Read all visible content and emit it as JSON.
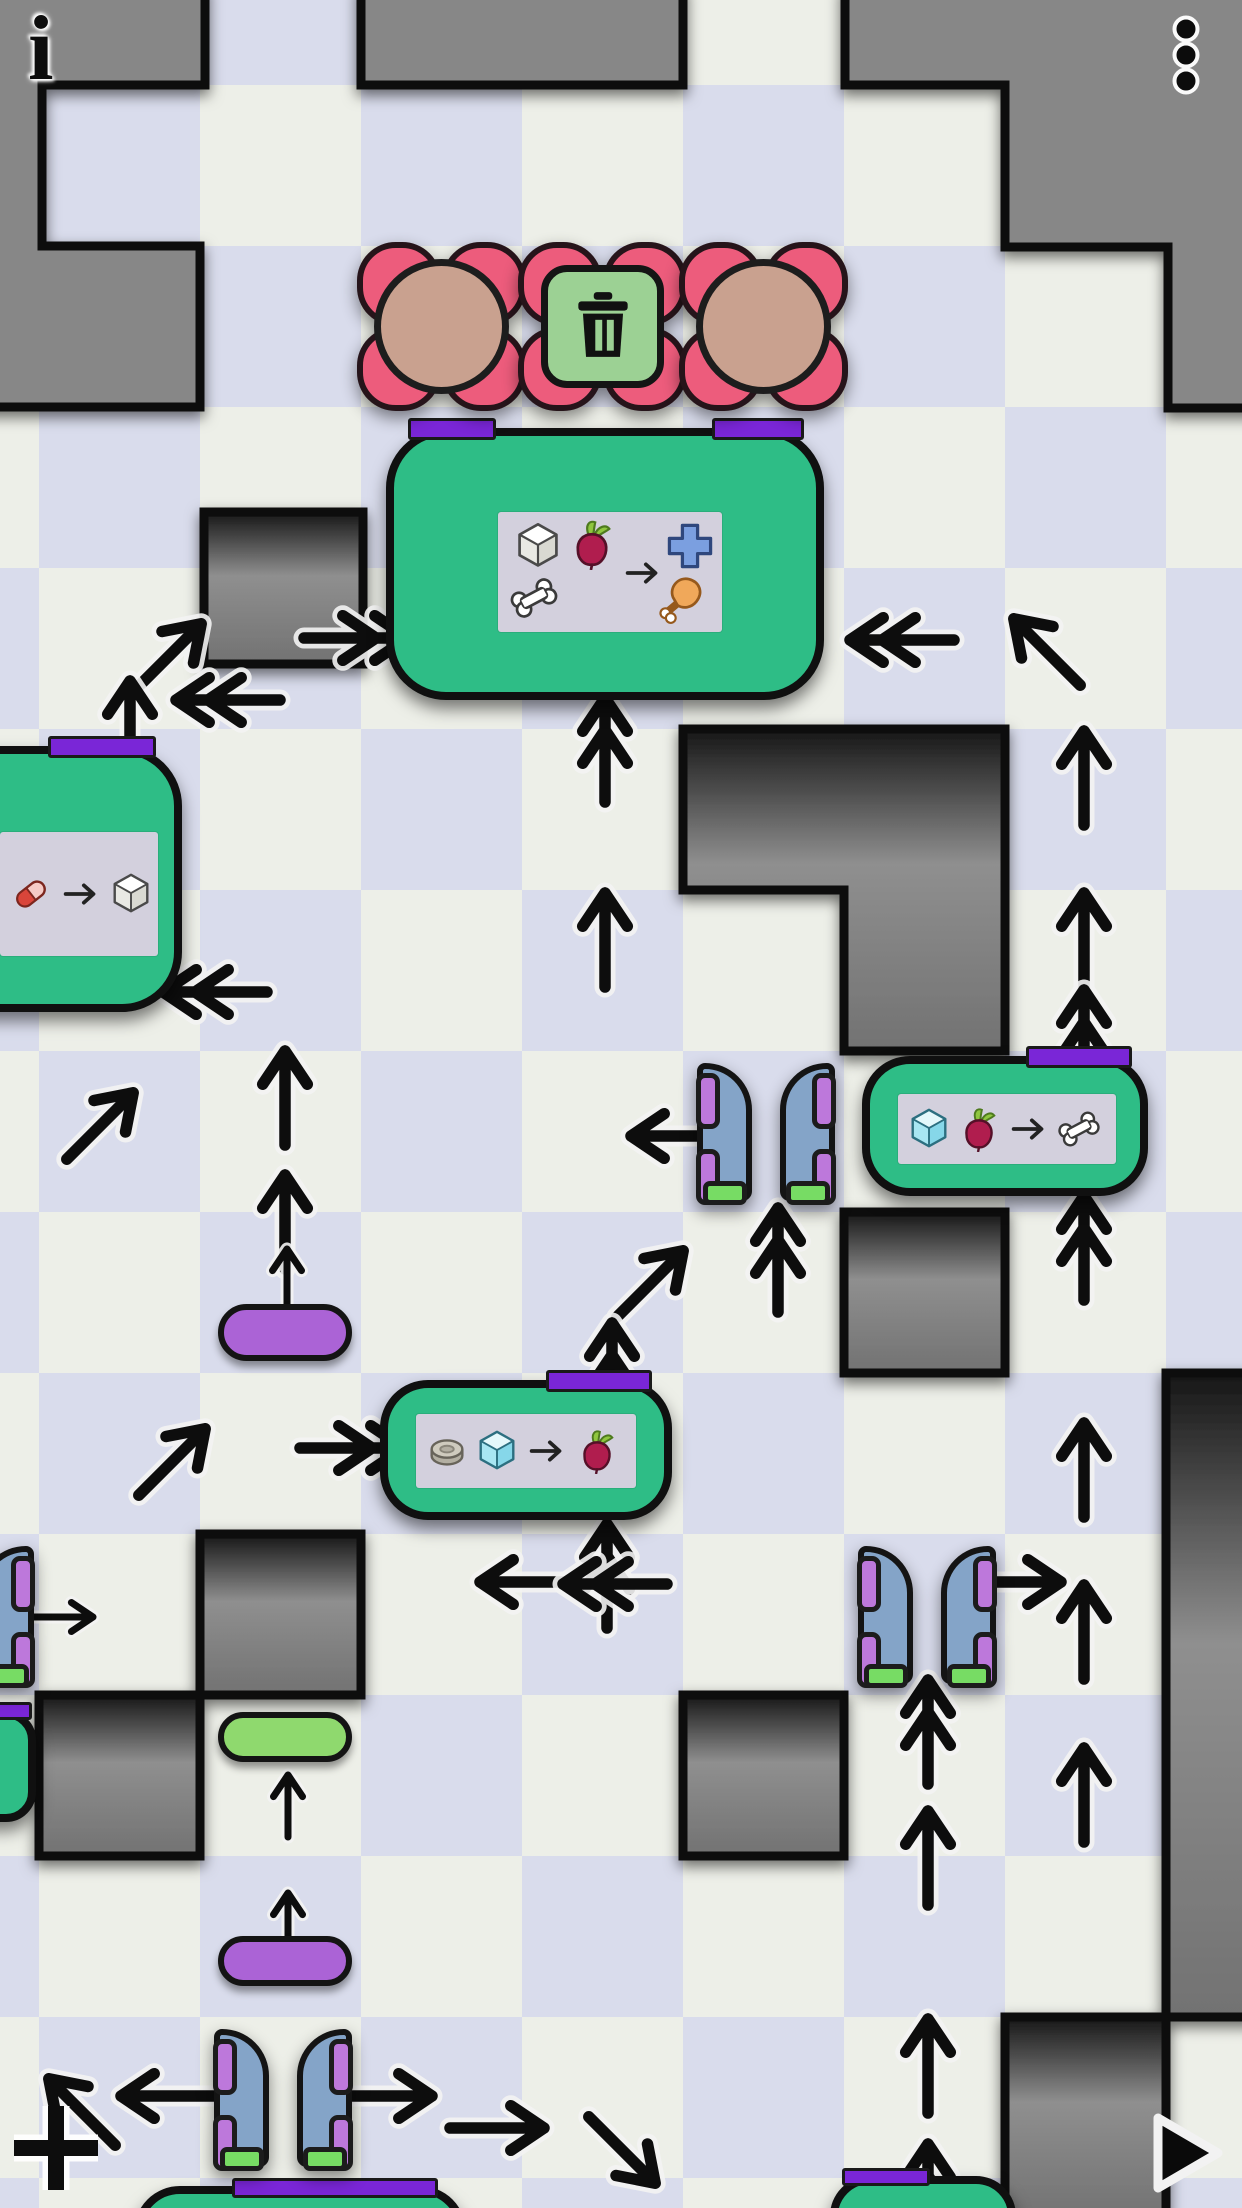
{
  "app": {
    "title": "factory puzzle level"
  },
  "hud": {
    "info_glyph": "i",
    "menu_icon": "vertical-ellipsis-icon",
    "add_icon": "plus-icon",
    "play_icon": "play-triangle-icon"
  },
  "palette": {
    "checker_light": "#edefe8",
    "checker_dark": "#d9dcec",
    "wall_flat": "#878787",
    "wall_border": "#101010",
    "machine_green": "#2ebd86",
    "port_purple": "#7a26d7",
    "panel_gray": "#d3d0dd",
    "petal_pink": "#ed5c7c",
    "bear_tan": "#c9a18f",
    "trash_green": "#9cd194",
    "door_blue": "#84a4c8",
    "tab_purple": "#bd78db",
    "bar_green": "#77dc64",
    "pill_purple": "#ab63d6",
    "pill_green": "#8fd96e"
  },
  "board": {
    "tile_size": 161,
    "origin_x": 39,
    "origin_y": 85,
    "flat_walls": [
      "M-12 -12 H205 V85 H42 V246 H200 V407 H-12 Z",
      "M361 -12 H683 V85 H361 Z",
      "M845 -12 H1254 V408 H1168 V247 H1005 V85 H845 Z"
    ],
    "block_walls": [
      "M204 512 H363 V664 H204 Z",
      "M683 729 H1005 V1051 H844 V890 H683 Z",
      "M844 1212 H1005 V1373 H844 Z",
      "M200 1534 H361 V1695 H200 Z",
      "M39 1695 H200 V1856 H39 Z",
      "M683 1695 H844 V1856 H683 Z",
      "M1166 1373 H1254 V2017 H1166 Z",
      "M1005 2017 H1166 V2220 H1005 Z"
    ],
    "delivery_tiles": [
      {
        "x": 361,
        "y": 246,
        "kind": "bear"
      },
      {
        "x": 522,
        "y": 246,
        "kind": "trash"
      },
      {
        "x": 683,
        "y": 246,
        "kind": "bear"
      }
    ],
    "machines": [
      {
        "id": "crafter-plus-drumstick",
        "x": 386,
        "y": 428,
        "w": 438,
        "h": 272,
        "r": 60,
        "ports": [
          {
            "x": 408,
            "y": 418,
            "w": 88,
            "h": 22
          },
          {
            "x": 712,
            "y": 418,
            "w": 92,
            "h": 22
          }
        ],
        "panel": {
          "x": 498,
          "y": 512,
          "w": 224,
          "h": 120,
          "layout": "grid"
        },
        "recipe": {
          "inputs": [
            "white-cube",
            "beet",
            "bone"
          ],
          "outputs": [
            "blue-plus",
            "drumstick"
          ]
        }
      },
      {
        "id": "crafter-white-cube",
        "x": -130,
        "y": 746,
        "w": 312,
        "h": 266,
        "r": 60,
        "ports": [
          {
            "x": 48,
            "y": 736,
            "w": 108,
            "h": 22
          }
        ],
        "panel": {
          "x": 0,
          "y": 832,
          "w": 158,
          "h": 124,
          "layout": "row"
        },
        "recipe": {
          "inputs": [
            "capsule"
          ],
          "outputs": [
            "white-cube"
          ]
        }
      },
      {
        "id": "crafter-bone",
        "x": 862,
        "y": 1056,
        "w": 286,
        "h": 140,
        "r": 48,
        "ports": [
          {
            "x": 1026,
            "y": 1046,
            "w": 106,
            "h": 22
          }
        ],
        "panel": {
          "x": 898,
          "y": 1094,
          "w": 218,
          "h": 70,
          "layout": "row"
        },
        "recipe": {
          "inputs": [
            "ice-cube",
            "beet"
          ],
          "outputs": [
            "bone"
          ]
        }
      },
      {
        "id": "crafter-beet",
        "x": 380,
        "y": 1380,
        "w": 292,
        "h": 140,
        "r": 48,
        "ports": [
          {
            "x": 546,
            "y": 1370,
            "w": 106,
            "h": 22
          }
        ],
        "panel": {
          "x": 416,
          "y": 1414,
          "w": 220,
          "h": 74,
          "layout": "row"
        },
        "recipe": {
          "inputs": [
            "disc",
            "ice-cube"
          ],
          "outputs": [
            "beet"
          ]
        }
      },
      {
        "id": "machine-bottom-left",
        "x": 134,
        "y": 2186,
        "w": 332,
        "h": 110,
        "r": 46,
        "ports": [
          {
            "x": 232,
            "y": 2178,
            "w": 206,
            "h": 20
          }
        ],
        "panel": null,
        "recipe": null
      },
      {
        "id": "machine-bottom-right",
        "x": 830,
        "y": 2176,
        "w": 186,
        "h": 96,
        "r": 40,
        "ports": [
          {
            "x": 842,
            "y": 2168,
            "w": 88,
            "h": 18
          }
        ],
        "panel": null,
        "recipe": null
      },
      {
        "id": "machine-left-edge",
        "x": -90,
        "y": 1710,
        "w": 126,
        "h": 112,
        "r": 30,
        "ports": [
          {
            "x": -6,
            "y": 1702,
            "w": 38,
            "h": 18
          }
        ],
        "panel": null,
        "recipe": null
      }
    ],
    "gate_pairs": [
      {
        "x": 683,
        "y": 1051
      },
      {
        "x": 844,
        "y": 1534
      },
      {
        "x": 200,
        "y": 2017
      },
      {
        "x": -118,
        "y": 1534
      }
    ],
    "pills": [
      {
        "x": 218,
        "y": 1304,
        "w": 134,
        "h": 57,
        "color": "#ab63d6"
      },
      {
        "x": 218,
        "y": 1712,
        "w": 134,
        "h": 50,
        "color": "#8fd96e"
      },
      {
        "x": 218,
        "y": 1936,
        "w": 134,
        "h": 50,
        "color": "#ab63d6"
      }
    ],
    "arrows": [
      {
        "x": 168,
        "y": 657,
        "d": -45,
        "t": "s"
      },
      {
        "x": 130,
        "y": 728,
        "d": -90,
        "t": "s"
      },
      {
        "x": 228,
        "y": 700,
        "d": 180,
        "t": "d"
      },
      {
        "x": 356,
        "y": 638,
        "d": 0,
        "t": "d"
      },
      {
        "x": 902,
        "y": 640,
        "d": 180,
        "t": "d"
      },
      {
        "x": 1047,
        "y": 652,
        "d": -135,
        "t": "s"
      },
      {
        "x": 605,
        "y": 750,
        "d": -90,
        "t": "d"
      },
      {
        "x": 605,
        "y": 940,
        "d": -90,
        "t": "s"
      },
      {
        "x": 1084,
        "y": 778,
        "d": -90,
        "t": "s"
      },
      {
        "x": 1084,
        "y": 940,
        "d": -90,
        "t": "s"
      },
      {
        "x": 1084,
        "y": 1042,
        "d": -90,
        "t": "d"
      },
      {
        "x": 215,
        "y": 992,
        "d": 180,
        "t": "d"
      },
      {
        "x": 285,
        "y": 1098,
        "d": -90,
        "t": "s"
      },
      {
        "x": 100,
        "y": 1126,
        "d": -45,
        "t": "s"
      },
      {
        "x": 285,
        "y": 1222,
        "d": -90,
        "t": "s"
      },
      {
        "x": 287,
        "y": 1280,
        "d": -90,
        "t": "m"
      },
      {
        "x": 678,
        "y": 1136,
        "d": 180,
        "t": "s"
      },
      {
        "x": 778,
        "y": 1260,
        "d": -90,
        "t": "d"
      },
      {
        "x": 650,
        "y": 1284,
        "d": -45,
        "t": "s"
      },
      {
        "x": 612,
        "y": 1375,
        "d": -90,
        "t": "d"
      },
      {
        "x": 352,
        "y": 1448,
        "d": 0,
        "t": "d"
      },
      {
        "x": 172,
        "y": 1462,
        "d": -45,
        "t": "s"
      },
      {
        "x": 607,
        "y": 1576,
        "d": -90,
        "t": "d"
      },
      {
        "x": 527,
        "y": 1582,
        "d": 180,
        "t": "s"
      },
      {
        "x": 615,
        "y": 1584,
        "d": 180,
        "t": "d"
      },
      {
        "x": 1014,
        "y": 1582,
        "d": 0,
        "t": "s"
      },
      {
        "x": 928,
        "y": 1732,
        "d": -90,
        "t": "d"
      },
      {
        "x": 1084,
        "y": 1248,
        "d": -90,
        "t": "d"
      },
      {
        "x": 1084,
        "y": 1470,
        "d": -90,
        "t": "s"
      },
      {
        "x": 1084,
        "y": 1632,
        "d": -90,
        "t": "s"
      },
      {
        "x": 1084,
        "y": 1795,
        "d": -90,
        "t": "s"
      },
      {
        "x": 928,
        "y": 1858,
        "d": -90,
        "t": "s"
      },
      {
        "x": 928,
        "y": 2066,
        "d": -90,
        "t": "s"
      },
      {
        "x": 928,
        "y": 2196,
        "d": -90,
        "t": "d"
      },
      {
        "x": 288,
        "y": 1806,
        "d": -90,
        "t": "m"
      },
      {
        "x": 288,
        "y": 1924,
        "d": -90,
        "t": "m"
      },
      {
        "x": 82,
        "y": 2112,
        "d": -135,
        "t": "s"
      },
      {
        "x": 168,
        "y": 2096,
        "d": 180,
        "t": "s"
      },
      {
        "x": 385,
        "y": 2096,
        "d": 0,
        "t": "s"
      },
      {
        "x": 497,
        "y": 2128,
        "d": 0,
        "t": "s"
      },
      {
        "x": 622,
        "y": 2150,
        "d": 45,
        "t": "s"
      },
      {
        "x": 62,
        "y": 1617,
        "d": 0,
        "t": "m"
      }
    ]
  }
}
